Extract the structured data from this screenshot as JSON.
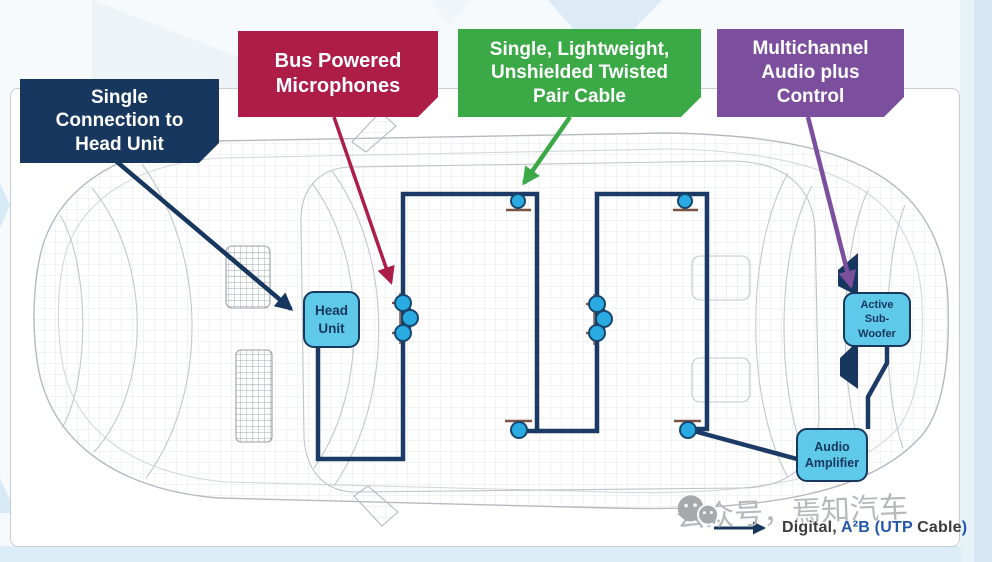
{
  "colors": {
    "navy": "#17375E",
    "crimson": "#AE1C48",
    "green": "#3BAA46",
    "purple": "#7B4E9E",
    "cable": "#1B3A66",
    "node_fill": "#29ABE2",
    "node_ring": "#17476E",
    "tick_brown": "#7B5243",
    "component_fill": "#5FC9EA",
    "legend_dark": "#3C3C3C",
    "legend_blue": "#2456A8",
    "watermark_gray": "#B6B9BC"
  },
  "callouts": {
    "single_connection": {
      "label": "Single\nConnection to\nHead Unit"
    },
    "bus_powered_mics": {
      "label": "Bus Powered\nMicrophones"
    },
    "utp_cable": {
      "label": "Single, Lightweight,\nUnshielded Twisted\nPair Cable"
    },
    "multichannel": {
      "label": "Multichannel\nAudio plus\nControl"
    }
  },
  "components": {
    "head_unit": {
      "label": "Head\nUnit"
    },
    "active_subwoofer": {
      "label": "Active\nSub-\nWoofer"
    },
    "audio_amplifier": {
      "label": "Audio\nAmplifier"
    }
  },
  "legend": {
    "prefix": "Digital, ",
    "bus_name": "A²B (UTP ",
    "cable_word": "Cable",
    "paren": ")"
  },
  "watermark": {
    "text": "公众号，焉知汽车"
  }
}
